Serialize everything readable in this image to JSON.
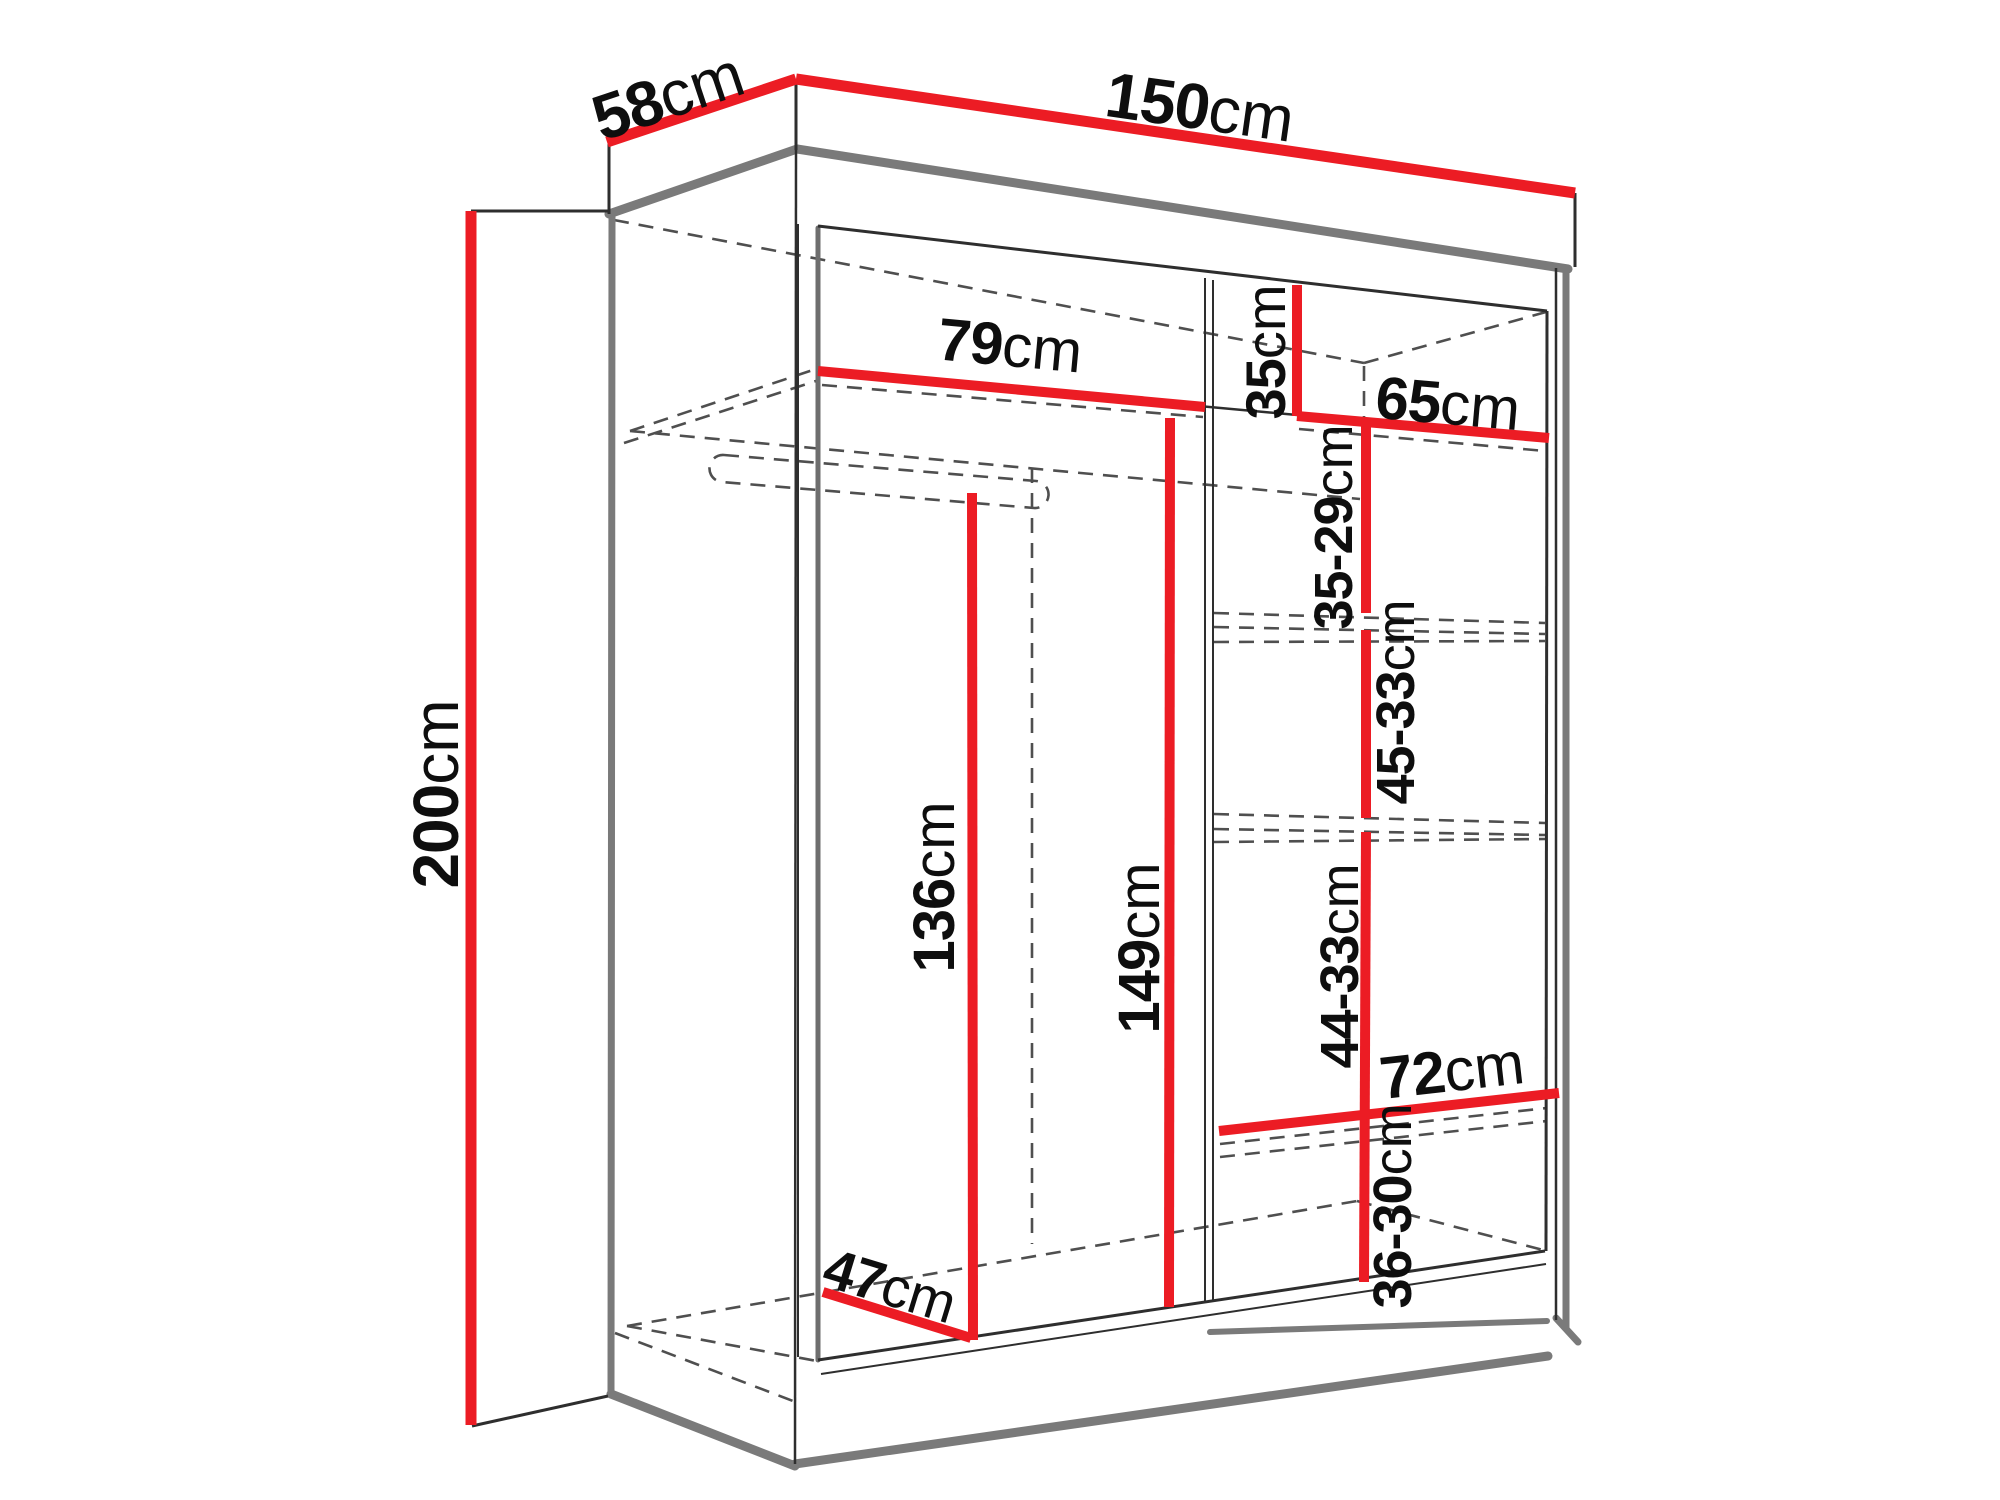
{
  "diagram": {
    "type": "furniture-dimension-diagram",
    "subject": "sliding-door wardrobe, open front view with interior shelf dimensions",
    "colors": {
      "dimension_line": "#ec1c24",
      "structure_heavy": "#7a7a7a",
      "structure_thin": "#3a3a3a",
      "hidden_dashed": "#4f4f4f",
      "label_text": "#0e0e0e",
      "background": "#ffffff"
    },
    "dimensions": {
      "depth": {
        "value": "58",
        "unit": "cm"
      },
      "width": {
        "value": "150",
        "unit": "cm"
      },
      "height": {
        "value": "200",
        "unit": "cm"
      },
      "left_width": {
        "value": "79",
        "unit": "cm"
      },
      "top_shelf": {
        "value": "35",
        "unit": "cm"
      },
      "right_width": {
        "value": "65",
        "unit": "cm"
      },
      "gap1": {
        "value": "35-29",
        "unit": "cm"
      },
      "gap2": {
        "value": "45-33",
        "unit": "cm"
      },
      "hang_height": {
        "value": "136",
        "unit": "cm"
      },
      "mid_height": {
        "value": "149",
        "unit": "cm"
      },
      "gap3": {
        "value": "44-33",
        "unit": "cm"
      },
      "bottom_width": {
        "value": "72",
        "unit": "cm"
      },
      "gap4": {
        "value": "36-30",
        "unit": "cm"
      },
      "bottom_depth": {
        "value": "47",
        "unit": "cm"
      }
    }
  }
}
